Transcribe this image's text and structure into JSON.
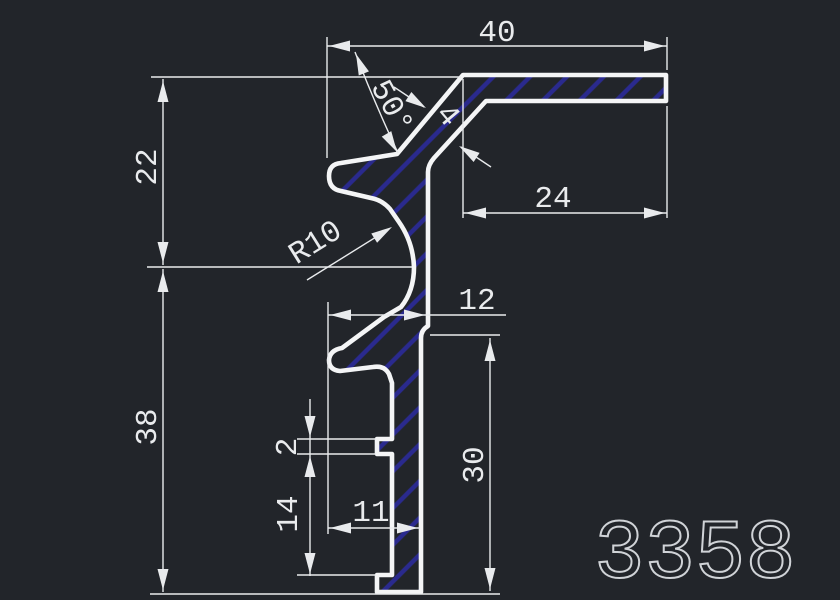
{
  "drawing": {
    "part_number": "3358",
    "dimensions": {
      "overall_width": "40",
      "flange_length": "24",
      "angle": "50°",
      "wall_thickness": "4",
      "fillet_radius": "R10",
      "upper_height": "22",
      "step_width": "12",
      "total_height": "38",
      "stem_height": "30",
      "notch_height": "2",
      "foot_offset": "14",
      "stem_width": "11"
    },
    "colors": {
      "background": "#22252a",
      "outline": "#f4f5f6",
      "hatch": "#2a2a8e",
      "dimension": "#e9ebed",
      "part_number": "#d0d3d7"
    }
  }
}
